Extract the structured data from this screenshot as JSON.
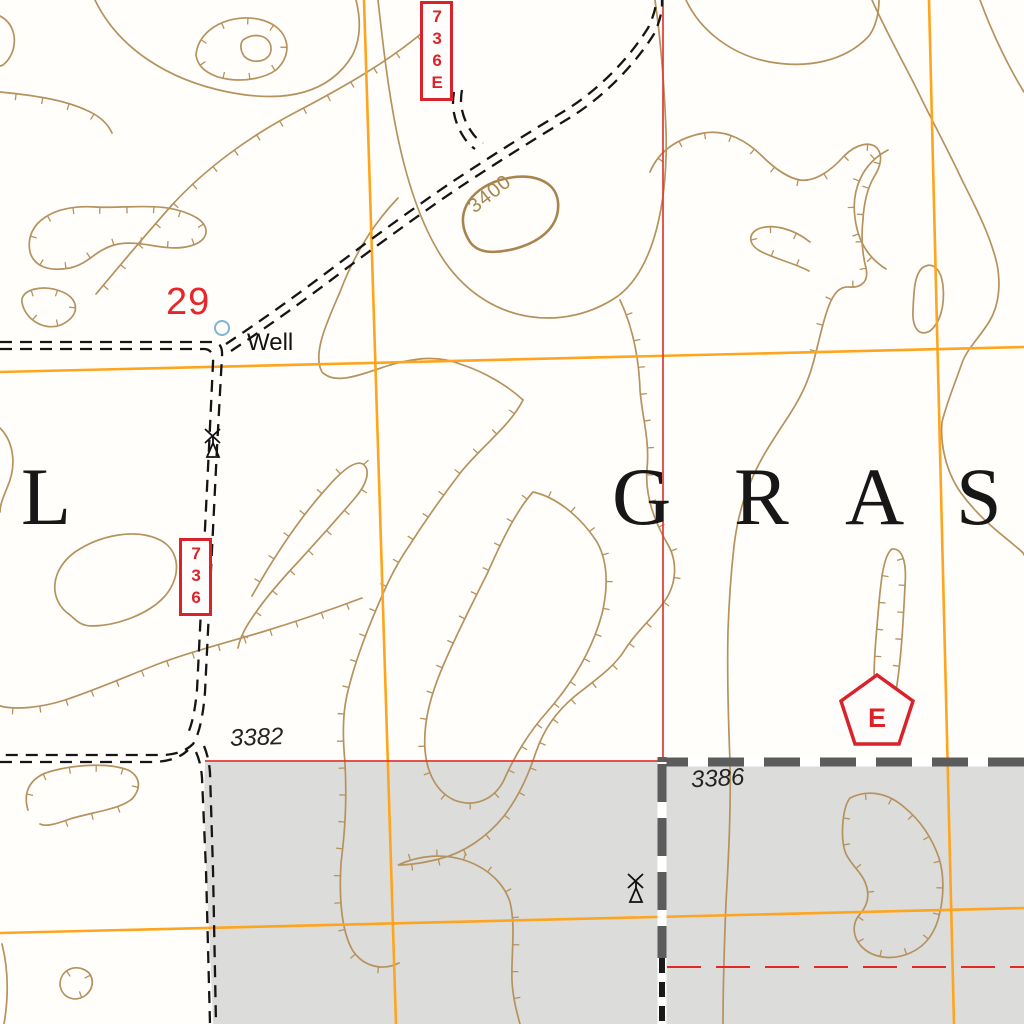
{
  "map": {
    "labels": {
      "route_marker_top": "736E",
      "route_marker_left": "736",
      "section_number": "29",
      "well": "Well",
      "contour_elevation": "3400",
      "spot_elevation_left": "3382",
      "spot_elevation_right": "3386",
      "boundary_corner_letter": "E",
      "grassland_partial_left": "L",
      "grassland_letters": [
        "G",
        "R",
        "A",
        "S"
      ]
    },
    "colors": {
      "contour": "#b5925e",
      "contour_index": "#a8854e",
      "grid_orange": "#ffa41e",
      "section_red": "#e03a34",
      "marker_red": "#d9232a",
      "land_gray": "#dcdcdb",
      "band_gray": "#5c5c5c",
      "road_black": "#151515",
      "water_blue": "#7fb4d5",
      "text_black": "#131313"
    }
  }
}
